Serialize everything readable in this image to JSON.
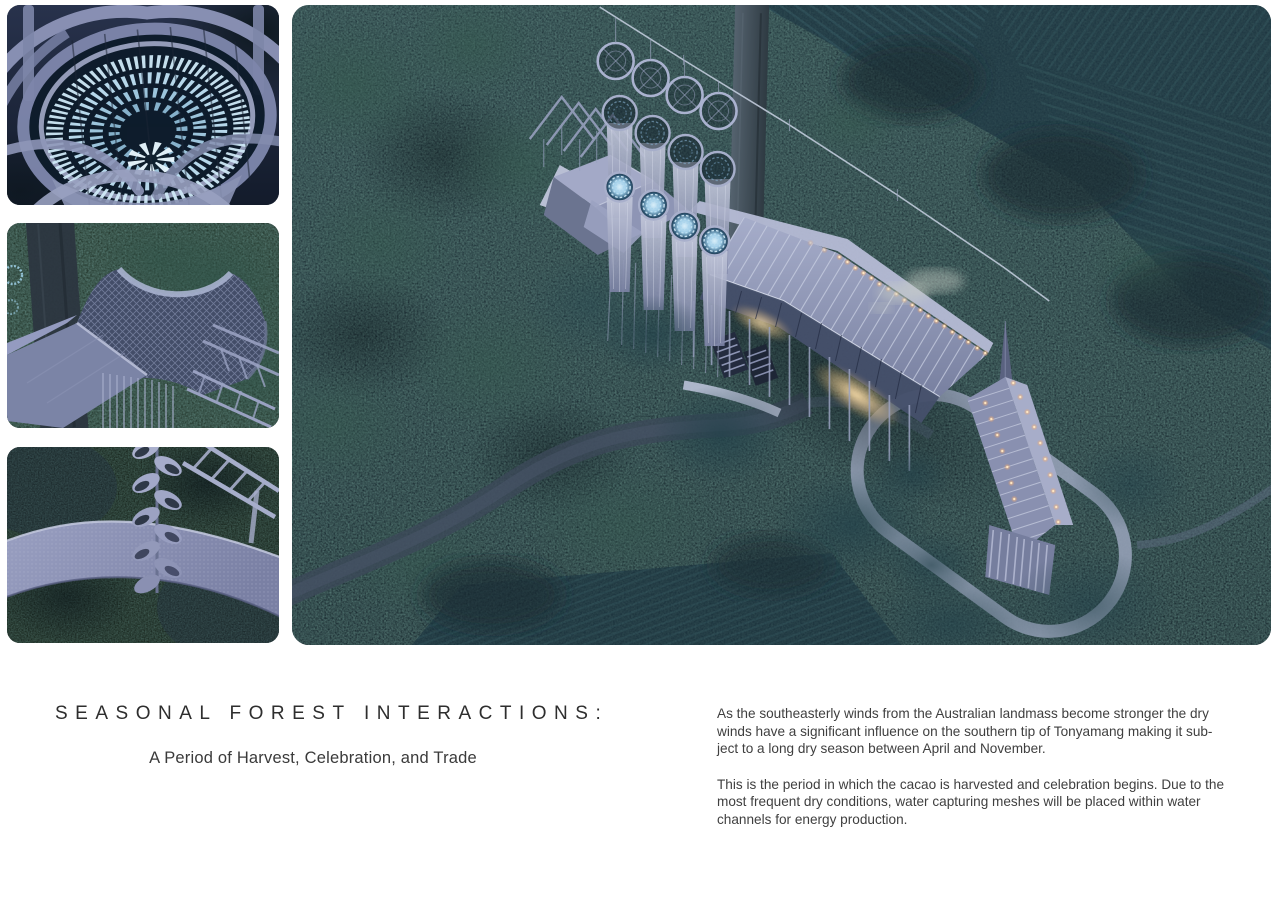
{
  "caption": {
    "title": "SEASONAL FOREST INTERACTIONS:",
    "subtitle": "A Period of Harvest, Celebration, and Trade",
    "paragraphs": [
      {
        "lines": [
          "As the southeasterly winds from the Australian landmass become stronger the dry",
          "winds have a significant influence on the southern tip of Tonyamang making it sub-",
          "ject to a long dry season between April and November."
        ]
      },
      {
        "lines": [
          "This is the period in which the cacao is harvested and celebration begins. Due to the",
          "most frequent dry conditions, water capturing meshes will be placed within water",
          "channels for energy production."
        ]
      }
    ]
  },
  "figures": {
    "detail_top": {
      "label": "illuminated-water-basket-bowl-detail"
    },
    "detail_middle": {
      "label": "water-capturing-mesh-roof-detail"
    },
    "detail_bottom": {
      "label": "walkway-and-spiral-column-detail"
    },
    "main": {
      "label": "aerial-night-render-of-longhouse-in-forest"
    }
  },
  "colors": {
    "page_bg": "#ffffff",
    "title": "#2e2e2e",
    "text": "#3f3f3f",
    "forest_dark": "#16262c",
    "field_teal": "#1d3641",
    "structure_lavender": "#9aa1c0",
    "glow_blue": "#bfe2f4",
    "torch_orange": "#ffaa5e",
    "window_glow": "#d9c584",
    "path_light": "#939eb4",
    "road_dark": "#3c4859"
  }
}
